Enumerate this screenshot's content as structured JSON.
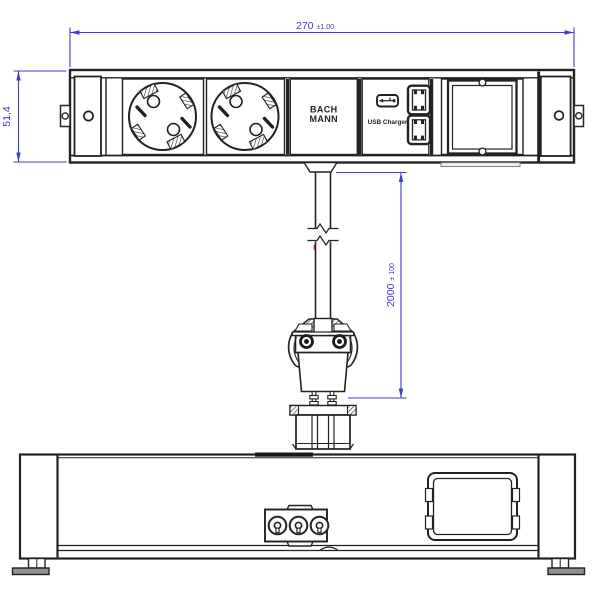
{
  "colors": {
    "line": "#222222",
    "dimension_blue": "#3c3ccd",
    "dark_fill": "#1b1b1b",
    "foot_gray": "#8f8f8f",
    "red_mark": "#cc3333",
    "background": "#ffffff"
  },
  "front_view": {
    "dim_width": {
      "value": "270",
      "tolerance": "±1.00"
    },
    "dim_height": {
      "value": "51,4"
    },
    "brand": {
      "line1": "BACH",
      "line2": "MANN"
    },
    "usb": {
      "label": "USB Charger",
      "ports": 2
    },
    "icons": {
      "socket": "schuko-socket-icon",
      "usb_plug": "usb-plug-icon",
      "usb_port": "usb-a-port-icon",
      "custom_module": "module-slot-icon",
      "screw": "screw-hole-icon",
      "bracket": "mounting-bracket-icon"
    }
  },
  "cable": {
    "dim_length": {
      "value": "2000",
      "tolerance": "± 100"
    },
    "icons": {
      "break": "cable-break-icon",
      "plug": "gst18-plug-icon"
    }
  },
  "rear_view": {
    "icons": {
      "connector": "gst18-3pole-connector-icon",
      "module_cutout": "module-cutout-icon",
      "foot": "levelling-foot-icon"
    }
  }
}
